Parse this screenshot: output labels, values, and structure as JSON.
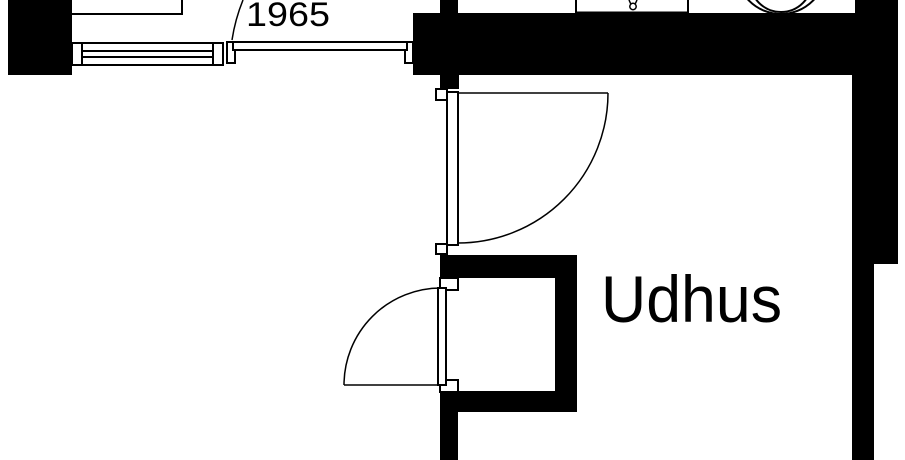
{
  "labels": {
    "year": "1965",
    "room": "Udhus"
  },
  "colors": {
    "wall": "#000000",
    "line": "#000000",
    "background": "#ffffff"
  }
}
